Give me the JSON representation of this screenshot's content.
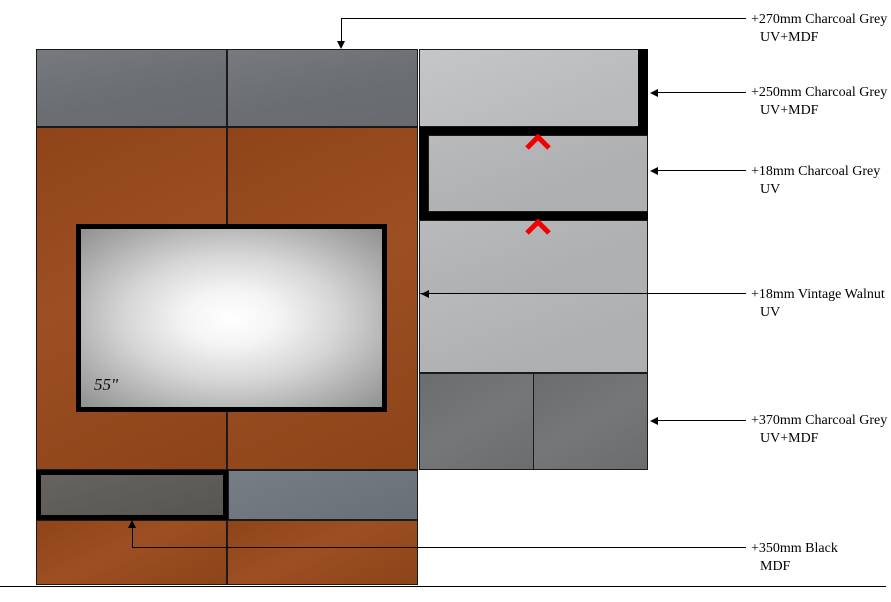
{
  "tv": {
    "size_label": "55\""
  },
  "annotations": [
    {
      "line1": "+270mm Charcoal Grey",
      "line2": "UV+MDF"
    },
    {
      "line1": "+250mm Charcoal Grey",
      "line2": "UV+MDF"
    },
    {
      "line1": "+18mm Charcoal Grey",
      "line2": "UV"
    },
    {
      "line1": "+18mm Vintage Walnut",
      "line2": "UV"
    },
    {
      "line1": "+370mm Charcoal Grey",
      "line2": "UV+MDF"
    },
    {
      "line1": "+350mm Black",
      "line2": "MDF"
    }
  ],
  "markers": {
    "chevron_icon": "chevron-up-icon",
    "chevron_color": "#F40000",
    "chevron_count": 2
  },
  "material_colors": {
    "vintage_walnut": "#98481A",
    "charcoal_grey_top": "#6F7377",
    "charcoal_grey_bottom": "#707274",
    "light_grey_uv": "#B5B6B8",
    "light_grey_uv_top": "#C2C3C5",
    "black_mdf": "#000000",
    "black_mdf_inner": "#5E5B57",
    "grey_strip": "#6E757E"
  }
}
